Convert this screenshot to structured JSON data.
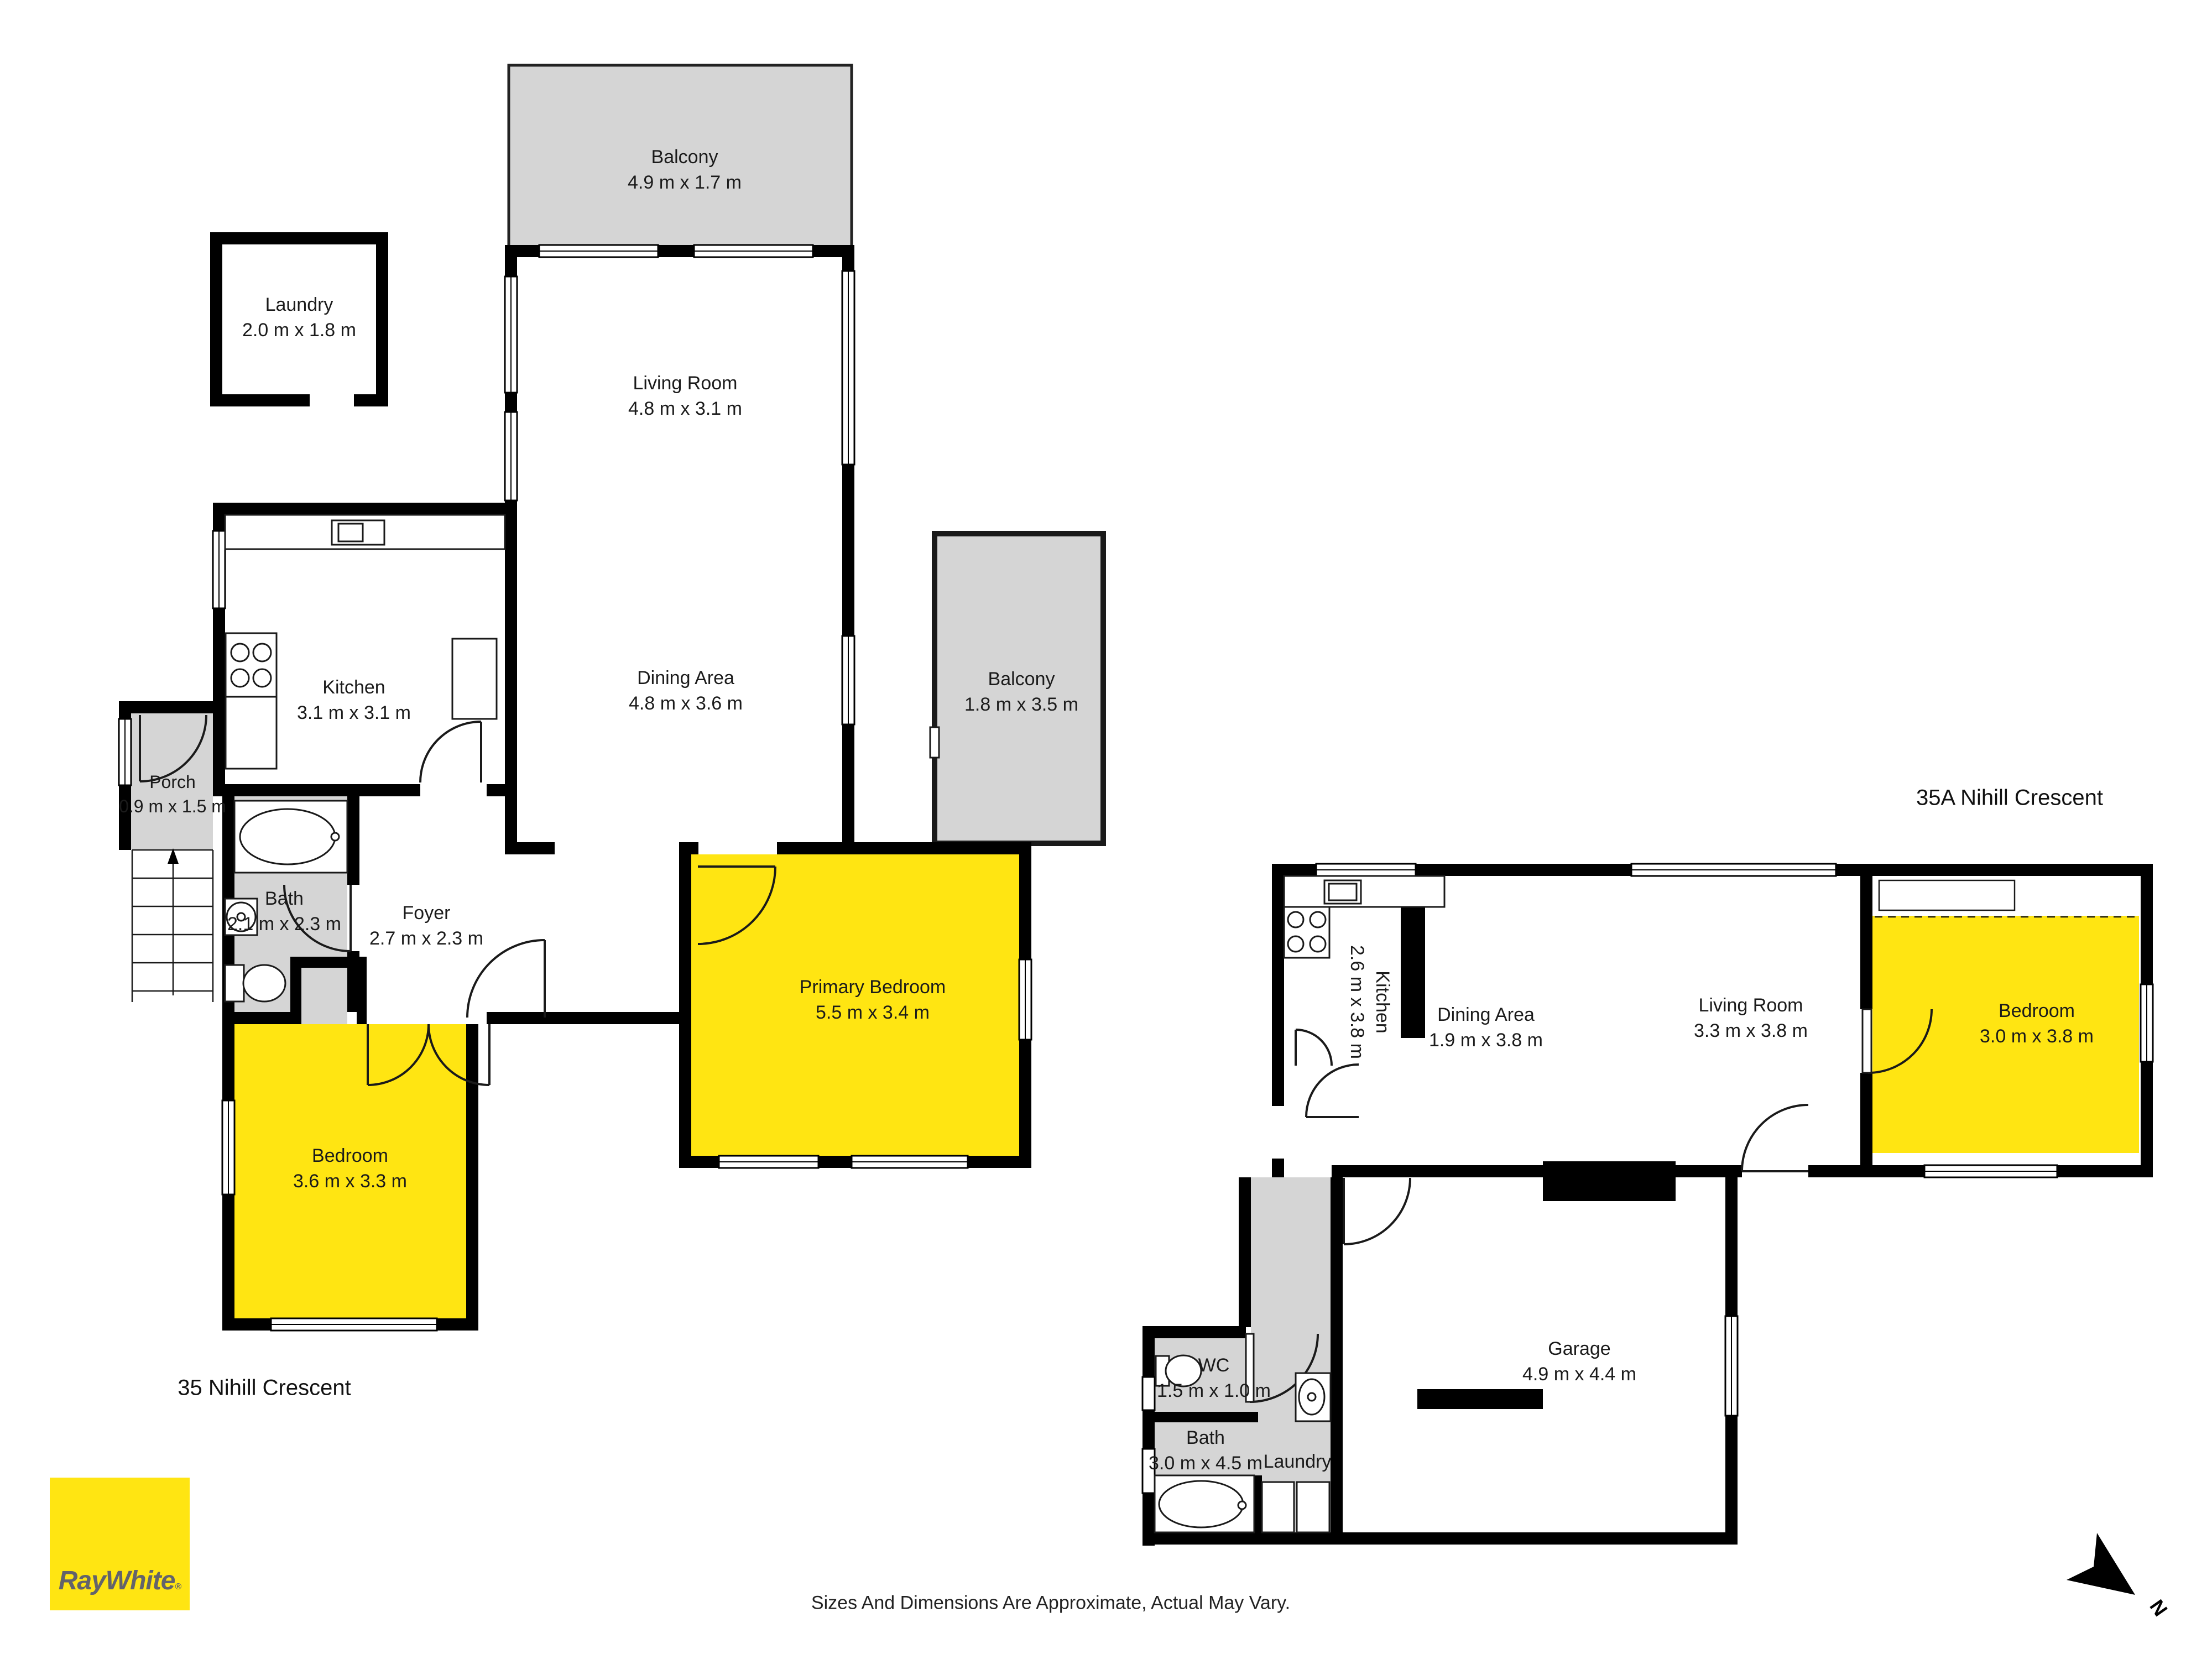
{
  "branding": {
    "logo_text": "RayWhite",
    "registered_mark": "®",
    "logo_color": "#ffe512",
    "logo_text_color": "#63636b"
  },
  "footer": {
    "disclaimer": "Sizes And Dimensions Are Approximate, Actual May Vary."
  },
  "compass": {
    "label": "N"
  },
  "colors": {
    "room_highlight": "#ffe512",
    "room_gray": "#d5d5d5",
    "wall": "#000000"
  },
  "units": [
    {
      "id": "unit-35",
      "address": "35 Nihill Crescent",
      "rooms": [
        {
          "key": "balcony_top",
          "name": "Balcony",
          "dims": "4.9 m x 1.7 m"
        },
        {
          "key": "laundry",
          "name": "Laundry",
          "dims": "2.0 m x 1.8 m"
        },
        {
          "key": "living",
          "name": "Living Room",
          "dims": "4.8 m x 3.1 m"
        },
        {
          "key": "dining",
          "name": "Dining Area",
          "dims": "4.8 m x 3.6 m"
        },
        {
          "key": "balcony_side",
          "name": "Balcony",
          "dims": "1.8 m x 3.5 m"
        },
        {
          "key": "kitchen",
          "name": "Kitchen",
          "dims": "3.1 m x 3.1 m"
        },
        {
          "key": "porch",
          "name": "Porch",
          "dims": "0.9 m x 1.5 m"
        },
        {
          "key": "bath",
          "name": "Bath",
          "dims": "2.1 m x 2.3 m"
        },
        {
          "key": "foyer",
          "name": "Foyer",
          "dims": "2.7 m x 2.3 m"
        },
        {
          "key": "primary_bedroom",
          "name": "Primary Bedroom",
          "dims": "5.5 m x 3.4 m"
        },
        {
          "key": "bedroom",
          "name": "Bedroom",
          "dims": "3.6 m x 3.3 m"
        }
      ]
    },
    {
      "id": "unit-35a",
      "address": "35A Nihill Crescent",
      "rooms": [
        {
          "key": "kitchen",
          "name": "Kitchen",
          "dims": "2.6 m x 3.8 m"
        },
        {
          "key": "dining",
          "name": "Dining Area",
          "dims": "1.9 m x 3.8 m"
        },
        {
          "key": "living",
          "name": "Living Room",
          "dims": "3.3 m x 3.8 m"
        },
        {
          "key": "bedroom",
          "name": "Bedroom",
          "dims": "3.0 m x 3.8 m"
        },
        {
          "key": "garage",
          "name": "Garage",
          "dims": "4.9 m x 4.4 m"
        },
        {
          "key": "wc",
          "name": "WC",
          "dims": "1.5 m x 1.0 m"
        },
        {
          "key": "bath",
          "name": "Bath",
          "dims": "3.0 m x 4.5 m"
        },
        {
          "key": "laundry",
          "name": "Laundry",
          "dims": ""
        }
      ]
    }
  ]
}
